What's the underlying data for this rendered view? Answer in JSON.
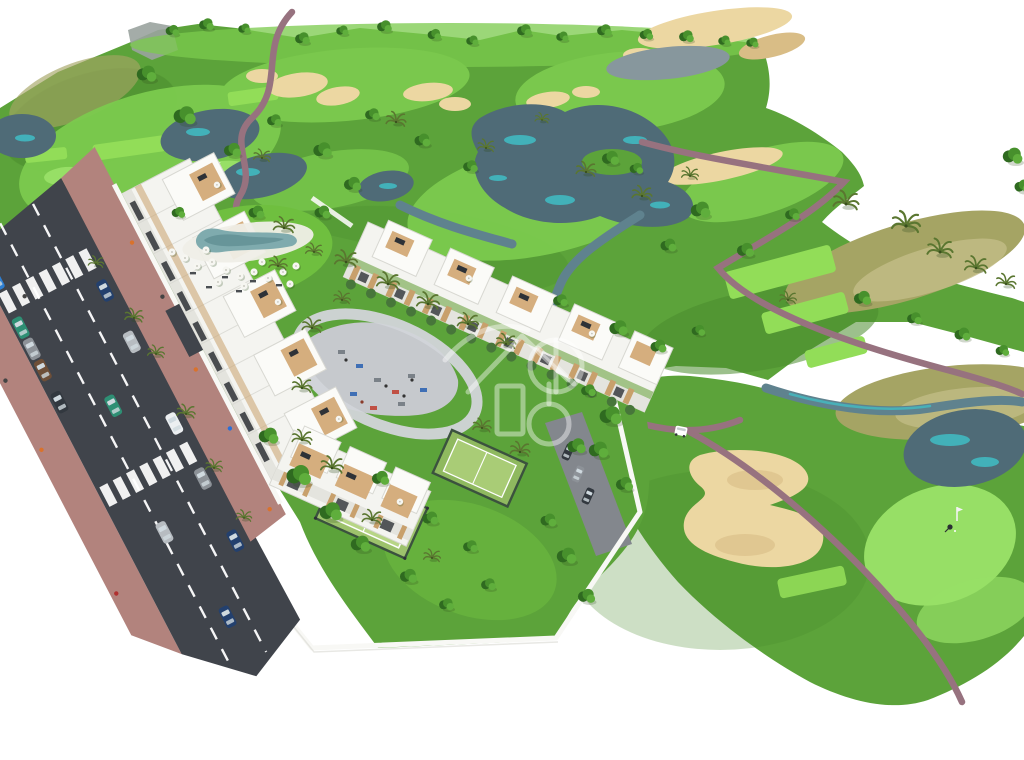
{
  "scene": {
    "title": "Aerial 3D architectural rendering of a white apartment complex beside a golf course with lakes, sand bunkers, a pool, padel courts, a playground and a two-lane road with parked cars",
    "type": "architectural-render",
    "watermark": "translucent white crest logo over the center of the development",
    "features": [
      "golf-course",
      "lakes-and-streams",
      "sand-bunkers",
      "fairways",
      "tee-boxes",
      "putting-greens-with-flags",
      "cart-paths",
      "palm-trees",
      "three-white-apartment-blocks",
      "rooftop-terraces",
      "swimming-pool-with-parasols",
      "playground-plaza",
      "padel-courts",
      "perimeter-white-walls",
      "two-lane-road",
      "zebra-crossings",
      "parked-cars",
      "golfer",
      "golf-cart"
    ],
    "counts": {
      "apartment_blocks": 3,
      "padel_courts": 2,
      "swimming_pools": 1,
      "zebra_crossings": 2,
      "golf_flags": 2,
      "golfers": 1,
      "golf_carts": 1,
      "road_cars": 15
    }
  },
  "palette": {
    "white": "#ffffff",
    "rock": "#9aa39f",
    "grassBase": "#5ca33a",
    "grassDark": "#4b8c2e",
    "grassBright": "#6fbf3f",
    "fairway": "#7ccb4e",
    "teeGreen": "#92dd58",
    "puttingGreen": "#97df66",
    "scrub": "#a5a464",
    "scrubLight": "#c3bd87",
    "sand": "#ecd7a2",
    "sandShade": "#d9bd86",
    "waterDark": "#4f6b77",
    "waterMid": "#5f828e",
    "waterGray": "#87979d",
    "teal": "#3fc3ca",
    "pathMauve": "#97727f",
    "roadAsphalt": "#40444b",
    "sidewalk": "#b2837d",
    "plazaGray": "#c6c9cd",
    "driveGray": "#83878d",
    "buildingWhite": "#f4f4f0",
    "buildingTop": "#fbfbf8",
    "buildingStroke": "#d8d8d2",
    "buildingShade": "#e4e4de",
    "wood": "#c8a06c",
    "deckTan": "#d5ae7e",
    "windowDark": "#2e3237",
    "bushGreen": "#47763a",
    "treeDark": "#2f6a20",
    "treeMid": "#47902c",
    "treeLight": "#5fae3c",
    "palmGreen": "#5a7630",
    "palmDark": "#394f1d",
    "shadow": "#2d4a1d",
    "poolWater": "#7fabae",
    "poolWaterDeep": "#5d8b90",
    "poolDeck": "#efeee7",
    "parasol": "#f6f6f1",
    "padelFence": "#3b523e",
    "padelCourt": "#9dc26c",
    "padelCourtIn": "#b7d586",
    "wallWhite": "#f8f8f5",
    "flagWhite": "#f2f2f2",
    "glass": "#cfd9df",
    "peopleOrange": "#d9722c",
    "carRed": "#c03a31",
    "carBlue": "#2d7fd3",
    "carTeal": "#2e8f74",
    "carSilver": "#b7bcc1",
    "carGray": "#8d9298",
    "carDark": "#32383f",
    "carNavy": "#23406e",
    "carBrown": "#6e4f38",
    "carWhite": "#eceff1",
    "watermark": "#ffffff"
  }
}
